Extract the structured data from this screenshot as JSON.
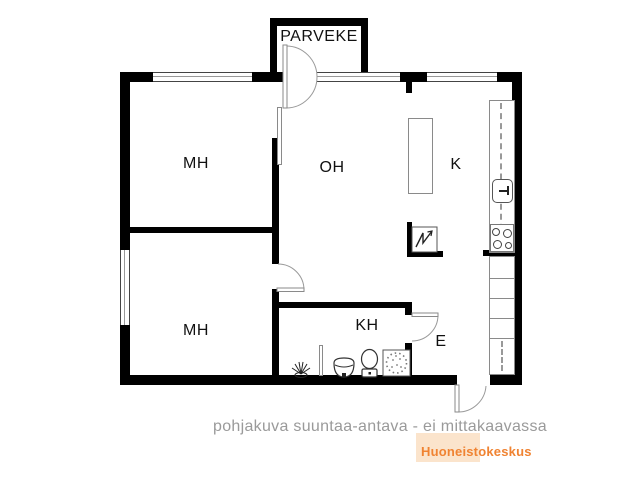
{
  "plan": {
    "type": "apartment-floor-plan",
    "rooms": [
      {
        "id": "parveke",
        "label": "PARVEKE"
      },
      {
        "id": "mh1",
        "label": "MH"
      },
      {
        "id": "oh",
        "label": "OH"
      },
      {
        "id": "k",
        "label": "K"
      },
      {
        "id": "mh2",
        "label": "MH"
      },
      {
        "id": "kh",
        "label": "KH"
      },
      {
        "id": "e",
        "label": "E"
      }
    ],
    "fixtures": [
      "balcony-door",
      "bedroom-door-leaf",
      "bedroom2-door",
      "bathroom-door",
      "entry-door",
      "window",
      "kitchen-counter",
      "kitchen-sink",
      "stove",
      "kitchen-island",
      "closets",
      "coat-rack",
      "electric-panel",
      "floor-drain",
      "shower-screen",
      "washbasin",
      "toilet",
      "shower-place"
    ]
  },
  "footer": {
    "disclaimer": "pohjakuva suuntaa-antava - ei mittakaavassa",
    "brand": "Huoneistokeskus"
  },
  "colors": {
    "wall": "#000000",
    "fixture_outline": "#8a8a8a",
    "disclaimer_text": "#9a9a9a",
    "brand_text": "#f08332",
    "brand_bg": "#fbe4cc"
  }
}
